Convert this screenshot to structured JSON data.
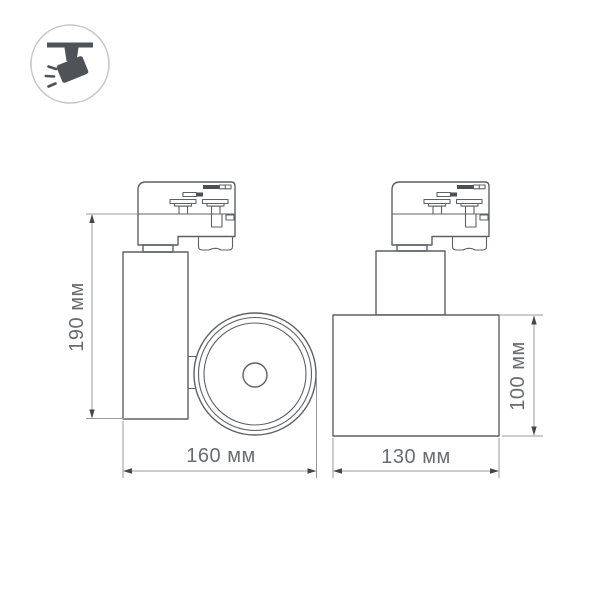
{
  "drawing": {
    "type": "product-dimension-drawing",
    "views": {
      "side": {
        "height_label": "190 мм",
        "width_label": "160 мм"
      },
      "front": {
        "width_label": "130 мм",
        "height_label": "100 мм"
      }
    }
  },
  "icon": {
    "name": "ceiling-track-spotlight"
  },
  "colors": {
    "background": "#ffffff",
    "outline": "#5d6165",
    "detail-fill": "#4b5054",
    "dim-line": "#97999c",
    "arrow": "#43474b",
    "label-text": "#696c6f",
    "icon-glyph": "#4e5357",
    "icon-circle": "#c6c8ca"
  }
}
